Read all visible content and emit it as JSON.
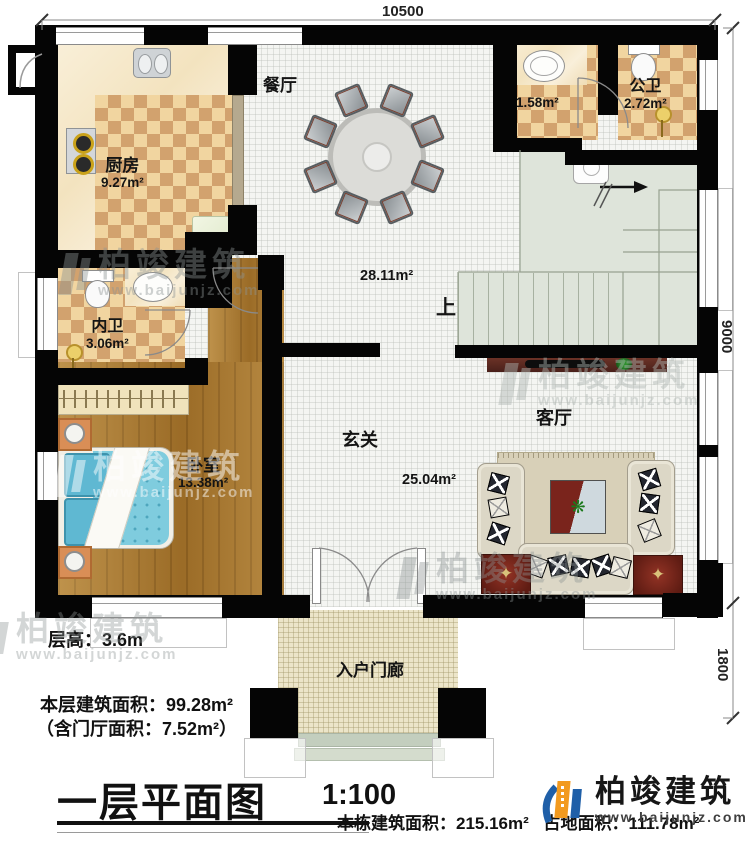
{
  "dimensions": {
    "top": "10500",
    "right_main": "9000",
    "right_porch": "1800"
  },
  "rooms": {
    "kitchen": {
      "name": "厨房",
      "area": "9.27m²"
    },
    "dining": {
      "name": "餐厅",
      "area": "28.11m²"
    },
    "washroom": {
      "area": "1.58m²"
    },
    "public_bath": {
      "name": "公卫",
      "area": "2.72m²"
    },
    "inner_bath": {
      "name": "内卫",
      "area": "3.06m²"
    },
    "bedroom": {
      "name": "卧室",
      "area": "13.38m²"
    },
    "foyer": {
      "name": "玄关",
      "area": "25.04m²"
    },
    "living": {
      "name": "客厅"
    },
    "porch": {
      "name": "入户门廊"
    },
    "stairs": {
      "up": "上"
    }
  },
  "annotations": {
    "floor_height": "层高：3.6m",
    "floor_area": "本层建筑面积：99.28m²",
    "hall_area": "（含门厅面积：7.52m²）",
    "building_area": "本栋建筑面积：215.16m²",
    "site_area": "占地面积：111.78m²"
  },
  "title_block": {
    "title": "一层平面图",
    "scale": "1:100"
  },
  "brand": {
    "name": "柏竣建筑",
    "website": "www.baijunjz.com"
  },
  "colors": {
    "wall": "#050505",
    "checker_dark": "#d2a26e",
    "checker_light": "#f1d5a0",
    "wood": "#a9782f",
    "stair": "#dee4da",
    "brand_blue": "#1f5fa8",
    "brand_orange": "#f29a1f"
  }
}
